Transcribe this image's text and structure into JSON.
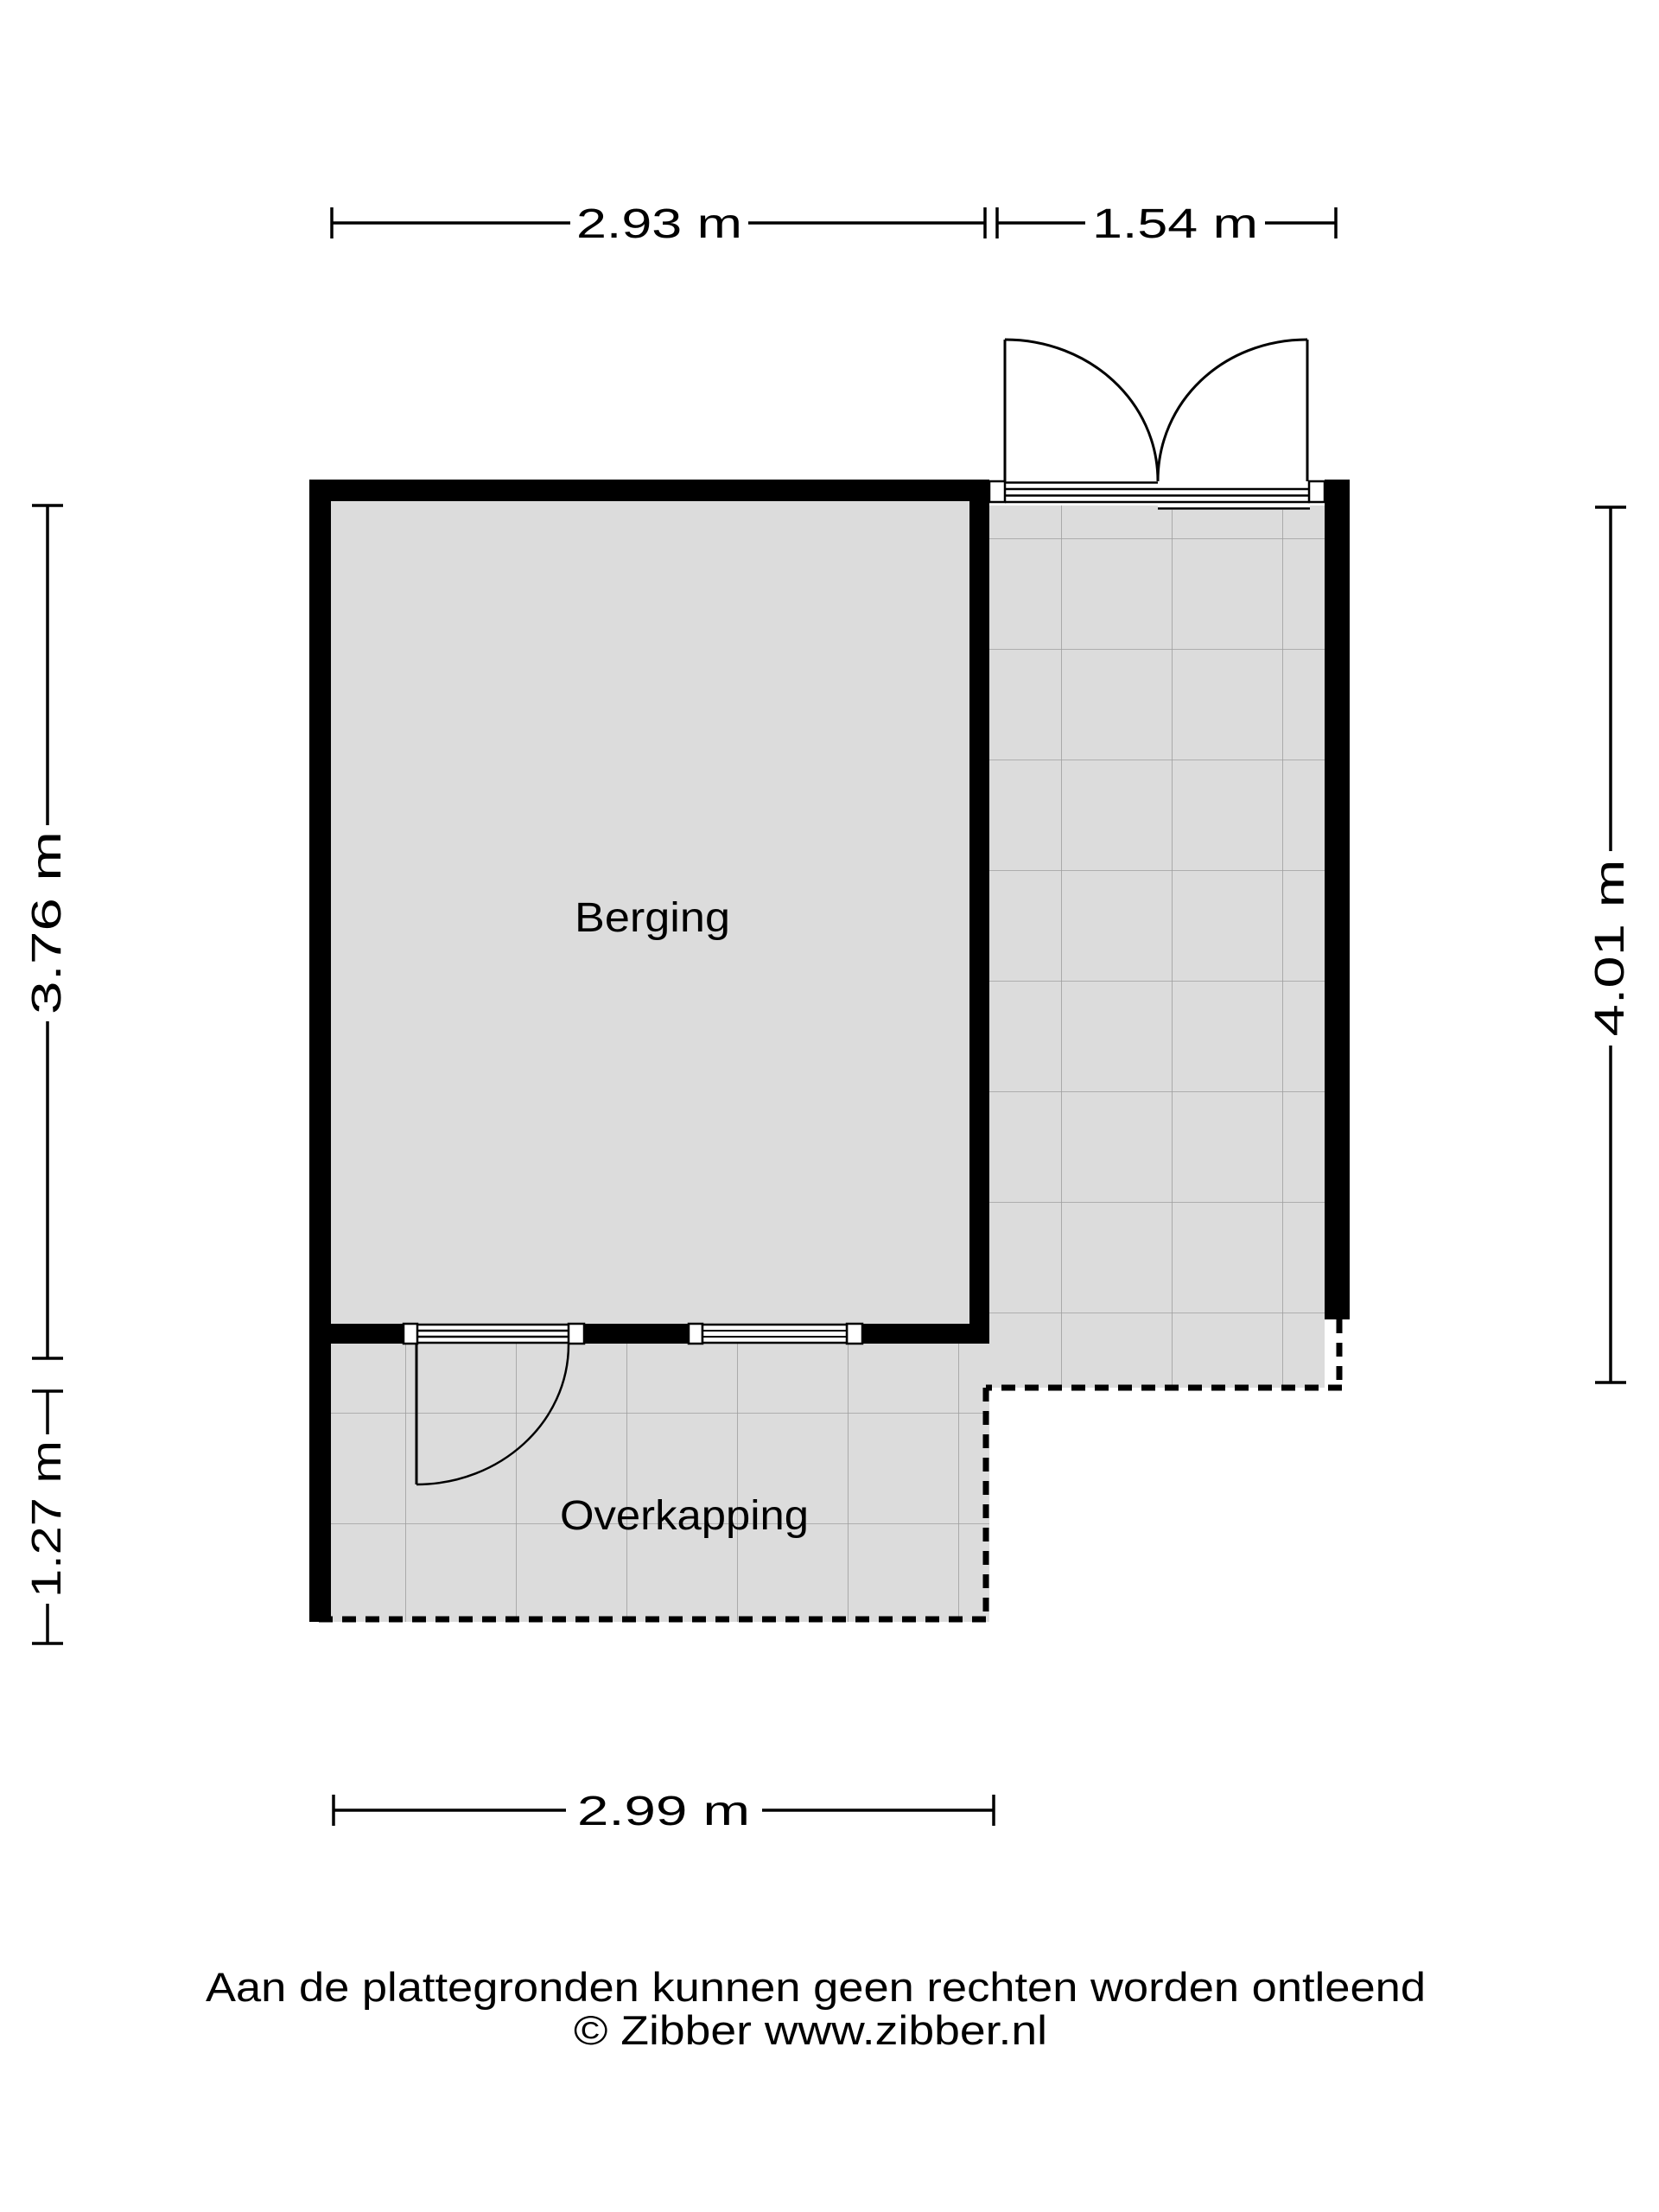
{
  "plan": {
    "rooms": [
      {
        "name": "Berging"
      },
      {
        "name": "Overkapping"
      }
    ],
    "dimensions": {
      "top": [
        {
          "label": "2.93 m"
        },
        {
          "label": "1.54 m"
        }
      ],
      "left": [
        {
          "label": "3.76 m"
        },
        {
          "label": "1.27 m"
        }
      ],
      "right": [
        {
          "label": "4.01 m"
        }
      ],
      "bottom": [
        {
          "label": "2.99 m"
        }
      ]
    },
    "features": {
      "double_door": "double swing doors at terrace top",
      "single_door": "single swing door to overkapping",
      "window": "window in berging rear wall",
      "open_boundary": "dashed open edges of terrace and overkapping"
    },
    "colors": {
      "floor_fill": "#dcdcdc",
      "wall": "#000000",
      "tile_line": "#9e9e9e",
      "line": "#000000",
      "background": "#ffffff"
    }
  },
  "footer": {
    "disclaimer": "Aan de plattegronden kunnen geen rechten worden ontleend",
    "copyright": "© Zibber www.zibber.nl"
  }
}
